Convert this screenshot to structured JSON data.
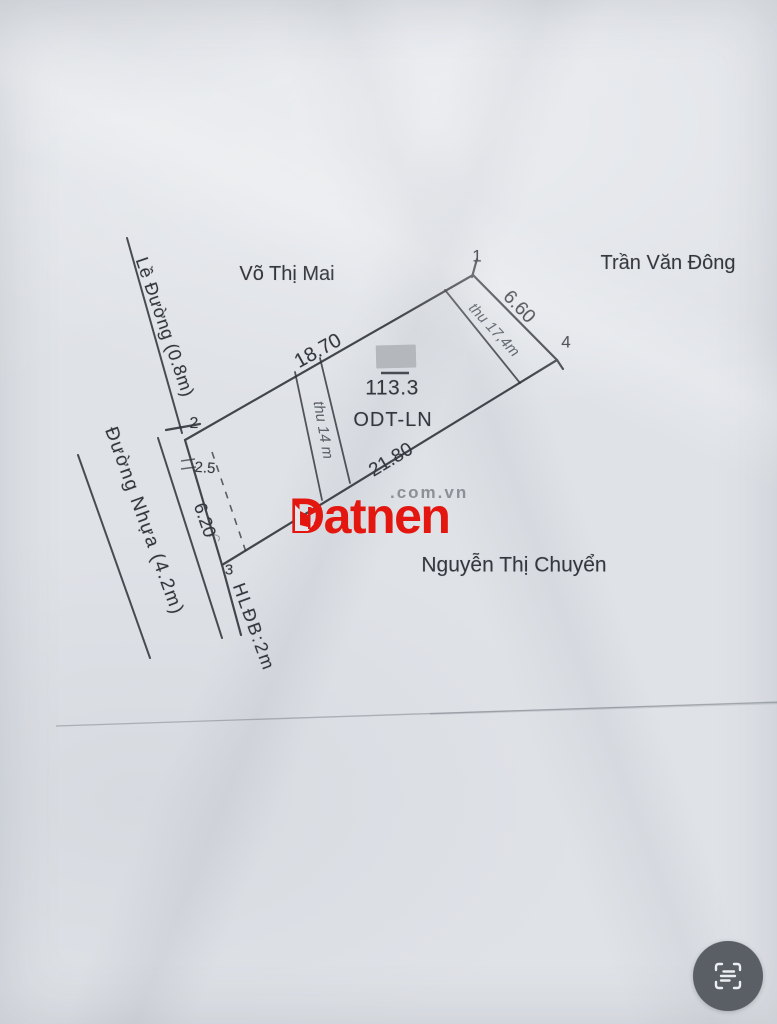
{
  "neighbors": {
    "top": "Võ Thị Mai",
    "right": "Trần Văn Đông",
    "bottom": "Nguyễn Thị Chuyển"
  },
  "parcel": {
    "points": {
      "p1": "1",
      "p2": "2",
      "p3": "3",
      "p4": "4"
    },
    "dimensions": {
      "top": "18.70",
      "right": "6.60",
      "bottom": "21.80",
      "left": "6.20",
      "offset": "2.5"
    },
    "area": "113.3",
    "land_use_code": "ODT-LN",
    "handwriting": {
      "middle_strip": "thu 14 m",
      "right_strip": "thu 17,4m"
    }
  },
  "roads": {
    "shoulder_label": "Lề Đường (0.8m)",
    "asphalt_label": "Đường Nhựa (4.2m)",
    "corridor_label": "HLĐB:2m"
  },
  "watermark": {
    "brand": "Datnen",
    "suffix": ".com.vn",
    "brand_color": "#e3170f",
    "suffix_color": "#8b9197"
  },
  "colors": {
    "paper": "#dfe2e7",
    "ink": "#2e3138",
    "redaction_gray": "#b4b7bc",
    "fab_gray": "#5a5f66"
  },
  "fab": {
    "icon": "scan-text-icon"
  }
}
